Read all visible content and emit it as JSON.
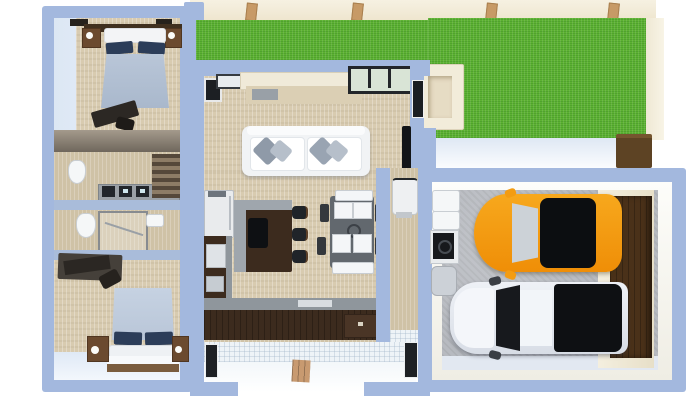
{
  "scene": {
    "description_name": "3d-floorplan-top-view",
    "rooms": [
      "bedroom-top",
      "bathroom-upper",
      "bathroom-lower",
      "bedroom-bottom",
      "living-room",
      "kitchen",
      "dining-area",
      "hallway-mudroom",
      "entry-porch",
      "garage",
      "lawn"
    ],
    "vehicles": [
      "orange-suv",
      "white-pickup-truck"
    ],
    "furniture": [
      "double-bed",
      "nightstand",
      "desk",
      "toilet",
      "vanity-counter",
      "shower",
      "sofa",
      "console-table",
      "tv",
      "fridge",
      "kitchen-island",
      "bar-stool",
      "l-counter",
      "dining-table",
      "dining-chair",
      "water-heater",
      "storage-shelf",
      "garage-door",
      "planter-box",
      "door-mat"
    ]
  },
  "palette": {
    "bg_white": "#ffffff",
    "wall_blue": "#a3b8de",
    "wall_face_light": "#dce7f4",
    "wall_face_lighter": "#eef4fb",
    "floor_beige": "#d8cbb0",
    "floor_tan": "#cfc2a6",
    "grass_green": "#5db233",
    "cream_wall": "#f2ecda",
    "concrete_gray": "#b7bac0",
    "tile_white": "#eef3f7",
    "cabinet_brown": "#3c2b1e",
    "counter_gray": "#8f969c",
    "island_gray": "#9fa6ad",
    "wood_brown": "#6b4a2f",
    "dark_wood_door": "#4a3119",
    "navy_pillow": "#2c3d59",
    "bed_blanket": "#b9c6d8",
    "sofa_white": "#f1f3f5",
    "pillow_gray": "#8f9aa8",
    "car_orange": "#f39c12",
    "truck_white": "#e3e7ee",
    "glass_dark": "#111317",
    "glass_light": "#ccd2d7",
    "table_gray": "#62686e",
    "chair_white": "#f4f6f8",
    "appliance_white": "#eef0f2",
    "brown_box": "#5d4324"
  }
}
